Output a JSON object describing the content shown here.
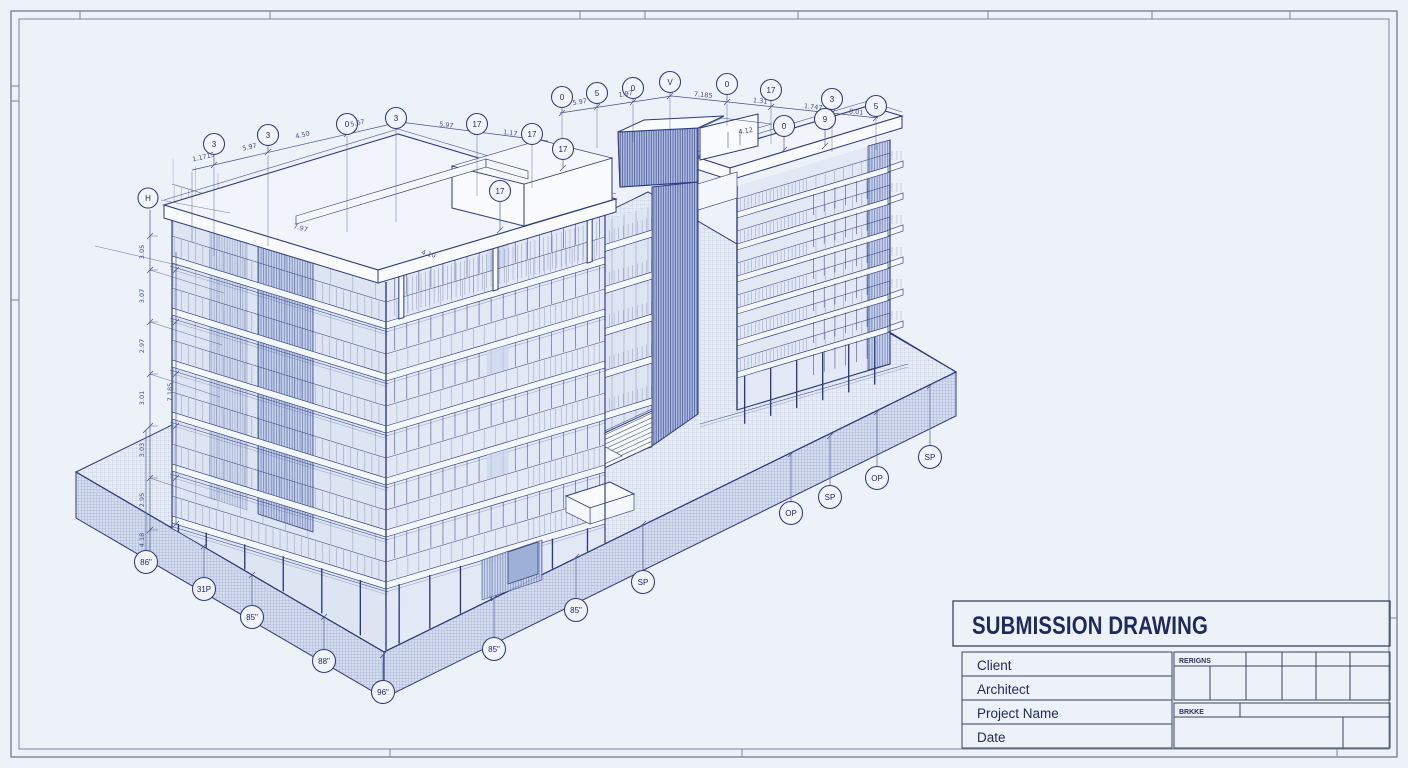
{
  "sheet": {
    "background": "#edf1f8",
    "ink_color": "#2b3a7e",
    "frame_color": "#7b8496",
    "drawing_type": "isometric building elevation"
  },
  "title_block": {
    "title": "SUBMISSION DRAWING",
    "rows": [
      {
        "label": "Client"
      },
      {
        "label": "Architect"
      },
      {
        "label": "Project Name"
      },
      {
        "label": "Date"
      }
    ],
    "revisions_label": "RERIGNS",
    "issue_label": "BRKKE"
  },
  "callouts": {
    "top_left": [
      {
        "label": "3",
        "x": 214,
        "y": 144,
        "ly": 165
      },
      {
        "label": "3",
        "x": 268,
        "y": 135,
        "ly": 152
      },
      {
        "label": "0",
        "x": 347,
        "y": 124,
        "ly": 134
      },
      {
        "label": "3",
        "x": 396,
        "y": 118,
        "ly": 123
      },
      {
        "label": "17",
        "x": 477,
        "y": 124,
        "ly": 132
      },
      {
        "label": "17",
        "x": 532,
        "y": 134,
        "ly": 139
      }
    ],
    "top_right": [
      {
        "label": "0",
        "x": 562,
        "y": 97,
        "ly": 113
      },
      {
        "label": "5",
        "x": 597,
        "y": 93,
        "ly": 107
      },
      {
        "label": "0",
        "x": 633,
        "y": 88,
        "ly": 102
      },
      {
        "label": "V",
        "x": 670,
        "y": 82,
        "ly": 96
      },
      {
        "label": "0",
        "x": 727,
        "y": 84,
        "ly": 102
      },
      {
        "label": "17",
        "x": 771,
        "y": 90,
        "ly": 107
      },
      {
        "label": "3",
        "x": 832,
        "y": 99,
        "ly": 113
      },
      {
        "label": "5",
        "x": 876,
        "y": 106,
        "ly": 118
      }
    ],
    "roof_inner": [
      {
        "label": "17",
        "x": 500,
        "y": 191,
        "ly": 230
      },
      {
        "label": "17",
        "x": 563,
        "y": 149,
        "ly": 168
      },
      {
        "label": "0",
        "x": 784,
        "y": 126,
        "ly": 150
      },
      {
        "label": "9",
        "x": 825,
        "y": 119,
        "ly": 146
      }
    ],
    "left_dim_bubble": {
      "label": "H",
      "x": 148,
      "y": 198
    },
    "bottom": [
      {
        "label": "86\"",
        "x": 146,
        "y": 562,
        "ly": 430
      },
      {
        "label": "31P",
        "x": 204,
        "y": 589,
        "ly": 546
      },
      {
        "label": "85\"",
        "x": 252,
        "y": 617,
        "ly": 575
      },
      {
        "label": "88\"",
        "x": 324,
        "y": 661,
        "ly": 617
      },
      {
        "label": "96\"",
        "x": 383,
        "y": 692,
        "ly": 655
      },
      {
        "label": "85\"",
        "x": 494,
        "y": 649,
        "ly": 598
      },
      {
        "label": "85\"",
        "x": 576,
        "y": 610,
        "ly": 557
      },
      {
        "label": "SP",
        "x": 643,
        "y": 582,
        "ly": 524
      },
      {
        "label": "OP",
        "x": 791,
        "y": 513,
        "ly": 454
      },
      {
        "label": "SP",
        "x": 830,
        "y": 497,
        "ly": 436
      },
      {
        "label": "OP",
        "x": 877,
        "y": 478,
        "ly": 412
      },
      {
        "label": "SP",
        "x": 930,
        "y": 457,
        "ly": 386
      }
    ]
  },
  "dim_texts": {
    "top_left": [
      {
        "x": 204,
        "y": 159,
        "r": -13,
        "v": "1.1715"
      },
      {
        "x": 250,
        "y": 149,
        "r": -13,
        "v": "5.97"
      },
      {
        "x": 303,
        "y": 137,
        "r": -13,
        "v": "4.50"
      },
      {
        "x": 358,
        "y": 125,
        "r": -13,
        "v": "5.67"
      },
      {
        "x": 446,
        "y": 127,
        "r": 8,
        "v": "5.97"
      },
      {
        "x": 510,
        "y": 135,
        "r": 8,
        "v": "1.17"
      }
    ],
    "top_right": [
      {
        "x": 580,
        "y": 104,
        "r": -9,
        "v": "5.97"
      },
      {
        "x": 626,
        "y": 96,
        "r": -9,
        "v": "1.97"
      },
      {
        "x": 703,
        "y": 97,
        "r": 6,
        "v": "7.185"
      },
      {
        "x": 760,
        "y": 103,
        "r": 6,
        "v": "1.31"
      },
      {
        "x": 813,
        "y": 109,
        "r": 6,
        "v": "1.747"
      },
      {
        "x": 856,
        "y": 114,
        "r": 6,
        "v": "8.01"
      }
    ],
    "roof": [
      {
        "x": 300,
        "y": 230,
        "r": 16,
        "v": "7.97"
      },
      {
        "x": 428,
        "y": 256,
        "r": 16,
        "v": "4.10"
      },
      {
        "x": 746,
        "y": 133,
        "r": -9,
        "v": "4.12"
      }
    ],
    "left_vertical": [
      {
        "x": 144,
        "y": 252,
        "r": -90,
        "v": "3.05"
      },
      {
        "x": 144,
        "y": 296,
        "r": -90,
        "v": "3.07"
      },
      {
        "x": 144,
        "y": 346,
        "r": -90,
        "v": "2.97"
      },
      {
        "x": 144,
        "y": 398,
        "r": -90,
        "v": "3.01"
      },
      {
        "x": 144,
        "y": 450,
        "r": -90,
        "v": "3.03"
      },
      {
        "x": 144,
        "y": 500,
        "r": -90,
        "v": "2.95"
      },
      {
        "x": 144,
        "y": 540,
        "r": -90,
        "v": "4.18"
      },
      {
        "x": 172,
        "y": 392,
        "r": -90,
        "v": "7.185"
      }
    ]
  }
}
